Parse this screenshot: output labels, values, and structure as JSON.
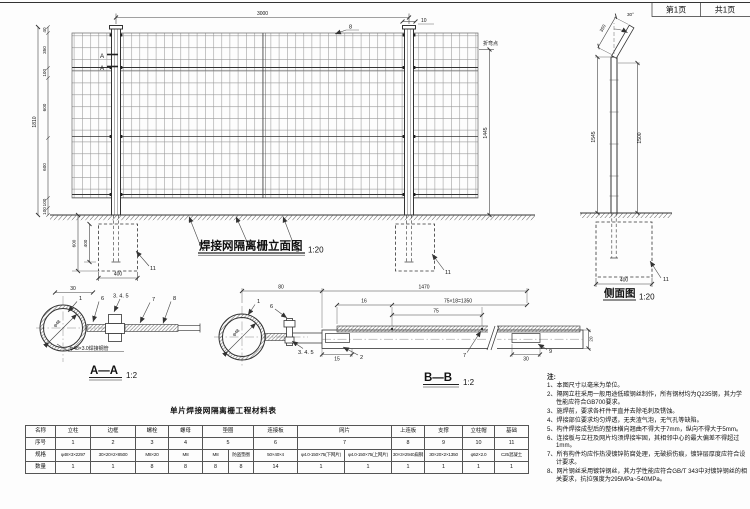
{
  "sheet": {
    "page_label": "第1页",
    "total_label": "共1页"
  },
  "elevation": {
    "title": "焊接网隔离栅立面图",
    "scale": "1:20",
    "dim_top_span": "3000",
    "dim_cap_width": "10",
    "callout_top_rail": "8",
    "left_dims": [
      "40",
      "350",
      "100",
      "600",
      "600",
      "100",
      "100"
    ],
    "dim_total_height": "1810",
    "bend_point_label": "折弯点",
    "dim_right_height": "1445",
    "dim_embed_depth": "400",
    "dim_foundation_depth": "600",
    "dim_foundation_width": "400",
    "callout_frame": "2",
    "callout_mesh": "7",
    "callout_bottom_rail": "9",
    "callout_foundation_left": "11",
    "callout_foundation_right": "11",
    "section_mark_top": "A",
    "section_mark_bottom": "A"
  },
  "side_view": {
    "title": "侧面图",
    "scale": "1:20",
    "angle": "30°",
    "dim_arm": "350",
    "dim_height_left": "1545",
    "dim_height_right": "1500",
    "dim_foundation_width": "400",
    "callout_foundation": "11"
  },
  "section_aa": {
    "title": "A—A",
    "scale": "1:2",
    "dim_top": "30",
    "dia_label": "φ48",
    "pipe_note": "φ48×3.0焊接钢管",
    "callout_post": "1",
    "callout_clamp": "6",
    "callout_bolt_set": "3. 4. 5",
    "callout_frame": "7",
    "callout_plate": "8"
  },
  "section_bb": {
    "title": "B—B",
    "scale": "1:2",
    "dim_offset": "80",
    "dim_panel": "1470",
    "dim_16": "16",
    "dim_wire_spacing": "75×18=1350",
    "dim_75": "75",
    "dim_15": "15",
    "dim_30": "30",
    "dim_20": "20",
    "dia_label": "φ48",
    "callout_post": "1",
    "callout_clamp": "6",
    "callout_bolt_set": "3. 4. 5",
    "callout_frame": "2",
    "callout_mesh": "7",
    "callout_support": "9"
  },
  "material_table": {
    "title": "单片焊接网隔离栅工程材料表",
    "row_headers": [
      "名称",
      "序号",
      "规格",
      "数量"
    ],
    "columns": [
      {
        "name": "立柱",
        "no": "1",
        "specs": [
          "φ48×3×2297"
        ],
        "qtys": [
          "1"
        ]
      },
      {
        "name": "边框",
        "no": "2",
        "specs": [
          "30×20×2×8500"
        ],
        "qtys": [
          "1"
        ]
      },
      {
        "name": "螺栓",
        "no": "3",
        "specs": [
          "M8×20"
        ],
        "qtys": [
          "8"
        ]
      },
      {
        "name": "螺母",
        "no": "4",
        "specs": [
          "M8"
        ],
        "qtys": [
          "8"
        ]
      },
      {
        "name": "垫圈",
        "no": "5",
        "specs": [
          "M8",
          "防盗垫圈"
        ],
        "qtys": [
          "8",
          "8"
        ]
      },
      {
        "name": "连接板",
        "no": "6",
        "specs": [
          "50×40×4"
        ],
        "qtys": [
          "14"
        ]
      },
      {
        "name": "网片",
        "no": "7",
        "specs": [
          "φ4.0-150×75(下网片)",
          "φ4.0-150×75(上网片)"
        ],
        "qtys": [
          "1",
          "1"
        ]
      },
      {
        "name": "上连板",
        "no": "8",
        "specs": [
          "30×3×2940扁钢"
        ],
        "qtys": [
          "1"
        ]
      },
      {
        "name": "支撑",
        "no": "9",
        "specs": [
          "30×20×2×1350"
        ],
        "qtys": [
          "1"
        ]
      },
      {
        "name": "立柱帽",
        "no": "10",
        "specs": [
          "φ52×2.0"
        ],
        "qtys": [
          "1"
        ]
      },
      {
        "name": "基础",
        "no": "11",
        "specs": [
          "C25混凝土"
        ],
        "qtys": [
          "1"
        ]
      }
    ]
  },
  "notes": {
    "heading": "注:",
    "items": [
      "1、本图尺寸以毫米为单位。",
      "2、隔网立柱采用一般用途低碳钢丝制作，所有钢材均为Q235钢，其力学性能应符合GB700要求。",
      "3、施焊前，要求各杆件平直并去除毛刺及锈蚀。",
      "4、焊接部位要求均匀焊透，无夹渣气泡，无气孔等缺陷。",
      "5、构件焊接成型后的整体横向翘曲不得大于7mm，纵向不得大于5mm。",
      "6、连接板与立柱及网片均须焊接牢固，其相邻中心的最大偏差不得超过1mm。",
      "7、所有构件均应作热浸镀锌防腐处理，无破损伤痕，镀锌层厚度应符合设计要求。",
      "8、网片钢丝采用镀锌钢丝，其力学性能应符合GB/T 343中对镀锌钢丝的相关要求，抗拉强度为295MPa~540MPa。"
    ]
  }
}
